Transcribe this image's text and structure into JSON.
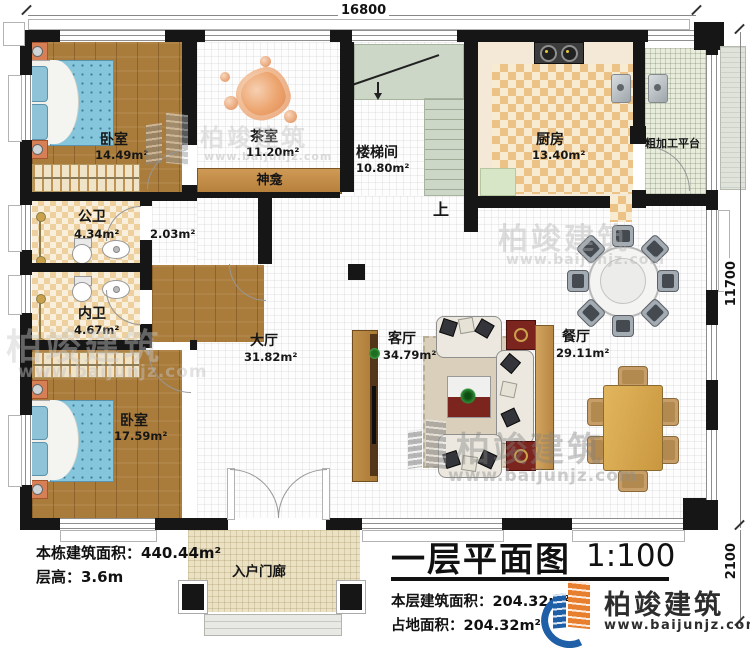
{
  "plan": {
    "title": "一层平面图",
    "scale": "1:100",
    "dim_top": "16800",
    "dim_right": "11700",
    "dim_bottom_right": "2100",
    "stairs_up": "上"
  },
  "rooms": [
    {
      "name": "卧室",
      "area": "14.49m²"
    },
    {
      "name": "茶室",
      "area": "11.20m²"
    },
    {
      "name": "楼梯间",
      "area": "10.80m²"
    },
    {
      "name": "厨房",
      "area": "13.40m²"
    },
    {
      "name": "粗加工平台",
      "area": ""
    },
    {
      "name": "神龛",
      "area": ""
    },
    {
      "name": "公卫",
      "area": "4.34m²"
    },
    {
      "name": "",
      "area": "2.03m²"
    },
    {
      "name": "内卫",
      "area": "4.67m²"
    },
    {
      "name": "大厅",
      "area": "31.82m²"
    },
    {
      "name": "客厅",
      "area": "34.79m²"
    },
    {
      "name": "餐厅",
      "area": "29.11m²"
    },
    {
      "name": "卧室",
      "area": "17.59m²"
    },
    {
      "name": "入户门廊",
      "area": ""
    }
  ],
  "notes": {
    "total_area": "本栋建筑面积：440.44m²",
    "floor_height": "层高：3.6m",
    "floor_area": "本层建筑面积：204.32m²",
    "footprint": "占地面积：204.32m²"
  },
  "brand": {
    "name": "柏竣建筑",
    "website": "www.baijunjz.com"
  },
  "colors": {
    "wall": "#161616",
    "wood_floor": "#aa7c3b",
    "checker_tan": "#ecc287",
    "stair_green": "#cdd7c8",
    "mattress_blue": "#85c6dc",
    "maroon_cabinet": "#7c241e",
    "dining_table_gold": "#d9aa52",
    "brand_blue": "#1f5fa8",
    "brand_orange": "#e87f2f"
  }
}
